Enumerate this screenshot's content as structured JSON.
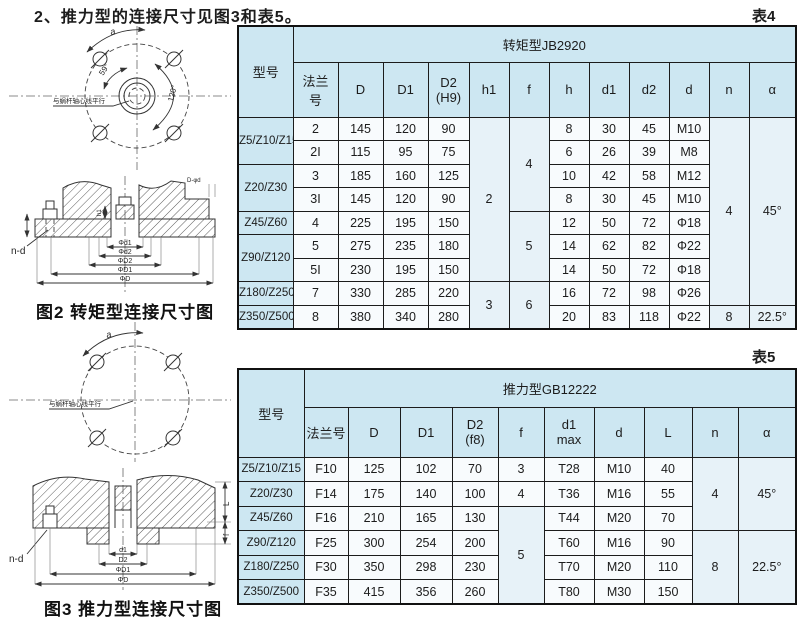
{
  "header": {
    "title": "2、推力型的连接尺寸见图3和表5。",
    "table4_tag": "表4",
    "table5_tag": "表5"
  },
  "figures": {
    "fig2": {
      "caption": "图2 转矩型连接尺寸图",
      "a_label": "a",
      "angle_small": "59°",
      "angle_large": "120°",
      "note": "与蜗杆轴心线平行",
      "bolt_label": "n-d",
      "top_right_label": "D-φd",
      "h1_label": "h1",
      "dims": [
        "Φd1",
        "Φd2",
        "ΦD2",
        "ΦD1",
        "ΦD"
      ]
    },
    "fig3": {
      "caption": "图3 推力型连接尺寸图",
      "a_label": "a",
      "note": "与蜗杆轴心线平行",
      "bolt_label": "n-d",
      "L_label": "L",
      "f_label": "f",
      "dims": [
        "d1",
        "D2",
        "ΦD1",
        "ΦD"
      ]
    }
  },
  "tables": {
    "table4": {
      "group_header": "转矩型JB2920",
      "rows": [
        [
          {
            "t": "型号",
            "th": 1,
            "rs": 2,
            "n": "col-header-model"
          },
          {
            "t": "转矩型JB2920",
            "th": 1,
            "cs": 12,
            "n": "table4-group-header"
          }
        ],
        [
          {
            "t": "法兰\n号",
            "th": 1,
            "n": "col-header"
          },
          {
            "t": "D",
            "th": 1,
            "n": "col-header"
          },
          {
            "t": "D1",
            "th": 1,
            "n": "col-header"
          },
          {
            "t": "D2\n(H9)",
            "th": 1,
            "n": "col-header"
          },
          {
            "t": "h1",
            "th": 1,
            "n": "col-header"
          },
          {
            "t": "f",
            "th": 1,
            "n": "col-header"
          },
          {
            "t": "h",
            "th": 1,
            "n": "col-header"
          },
          {
            "t": "d1",
            "th": 1,
            "n": "col-header"
          },
          {
            "t": "d2",
            "th": 1,
            "n": "col-header"
          },
          {
            "t": "d",
            "th": 1,
            "n": "col-header"
          },
          {
            "t": "n",
            "th": 1,
            "n": "col-header"
          },
          {
            "t": "α",
            "th": 1,
            "n": "col-header"
          }
        ],
        [
          {
            "t": "Z5/Z10/Z15",
            "rs": 2,
            "cls": "model",
            "n": "row-header"
          },
          {
            "t": "2"
          },
          {
            "t": "145"
          },
          {
            "t": "120"
          },
          {
            "t": "90"
          },
          {
            "t": "2",
            "rs": 7,
            "cls": "span"
          },
          {
            "t": "4",
            "rs": 4,
            "cls": "span"
          },
          {
            "t": "8"
          },
          {
            "t": "30"
          },
          {
            "t": "45"
          },
          {
            "t": "M10"
          },
          {
            "t": "4",
            "rs": 8,
            "cls": "span"
          },
          {
            "t": "45°",
            "rs": 8,
            "cls": "span"
          }
        ],
        [
          {
            "t": "2I"
          },
          {
            "t": "115"
          },
          {
            "t": "95"
          },
          {
            "t": "75"
          },
          {
            "t": "6"
          },
          {
            "t": "26"
          },
          {
            "t": "39"
          },
          {
            "t": "M8"
          }
        ],
        [
          {
            "t": "Z20/Z30",
            "rs": 2,
            "cls": "model",
            "n": "row-header"
          },
          {
            "t": "3"
          },
          {
            "t": "185"
          },
          {
            "t": "160"
          },
          {
            "t": "125"
          },
          {
            "t": "10"
          },
          {
            "t": "42"
          },
          {
            "t": "58"
          },
          {
            "t": "M12"
          }
        ],
        [
          {
            "t": "3I"
          },
          {
            "t": "145"
          },
          {
            "t": "120"
          },
          {
            "t": "90"
          },
          {
            "t": "8"
          },
          {
            "t": "30"
          },
          {
            "t": "45"
          },
          {
            "t": "M10"
          }
        ],
        [
          {
            "t": "Z45/Z60",
            "cls": "model",
            "n": "row-header"
          },
          {
            "t": "4"
          },
          {
            "t": "225"
          },
          {
            "t": "195"
          },
          {
            "t": "150"
          },
          {
            "t": "5",
            "rs": 3,
            "cls": "span"
          },
          {
            "t": "12"
          },
          {
            "t": "50"
          },
          {
            "t": "72"
          },
          {
            "t": "Φ18"
          }
        ],
        [
          {
            "t": "Z90/Z120",
            "rs": 2,
            "cls": "model",
            "n": "row-header"
          },
          {
            "t": "5"
          },
          {
            "t": "275"
          },
          {
            "t": "235"
          },
          {
            "t": "180"
          },
          {
            "t": "14"
          },
          {
            "t": "62"
          },
          {
            "t": "82"
          },
          {
            "t": "Φ22"
          }
        ],
        [
          {
            "t": "5I"
          },
          {
            "t": "230"
          },
          {
            "t": "195"
          },
          {
            "t": "150"
          },
          {
            "t": "14"
          },
          {
            "t": "50"
          },
          {
            "t": "72"
          },
          {
            "t": "Φ18"
          }
        ],
        [
          {
            "t": "Z180/Z250",
            "cls": "model",
            "n": "row-header"
          },
          {
            "t": "7"
          },
          {
            "t": "330"
          },
          {
            "t": "285"
          },
          {
            "t": "220"
          },
          {
            "t": "3",
            "rs": 2,
            "cls": "span"
          },
          {
            "t": "6",
            "rs": 2,
            "cls": "span"
          },
          {
            "t": "16"
          },
          {
            "t": "72"
          },
          {
            "t": "98"
          },
          {
            "t": "Φ26"
          }
        ],
        [
          {
            "t": "Z350/Z500",
            "cls": "model",
            "n": "row-header"
          },
          {
            "t": "8"
          },
          {
            "t": "380"
          },
          {
            "t": "340"
          },
          {
            "t": "280"
          },
          {
            "t": "20"
          },
          {
            "t": "83"
          },
          {
            "t": "118"
          },
          {
            "t": "Φ22"
          },
          {
            "t": "8",
            "cls": "span"
          },
          {
            "t": "22.5°",
            "cls": "span"
          }
        ]
      ]
    },
    "table5": {
      "group_header": "推力型GB12222",
      "rows": [
        [
          {
            "t": "型号",
            "th": 1,
            "rs": 2,
            "n": "col-header-model"
          },
          {
            "t": "推力型GB12222",
            "th": 1,
            "cs": 10,
            "n": "table5-group-header"
          }
        ],
        [
          {
            "t": "法兰号",
            "th": 1,
            "n": "col-header"
          },
          {
            "t": "D",
            "th": 1,
            "n": "col-header"
          },
          {
            "t": "D1",
            "th": 1,
            "n": "col-header"
          },
          {
            "t": "D2\n(f8)",
            "th": 1,
            "n": "col-header"
          },
          {
            "t": "f",
            "th": 1,
            "n": "col-header"
          },
          {
            "t": "d1\nmax",
            "th": 1,
            "n": "col-header"
          },
          {
            "t": "d",
            "th": 1,
            "n": "col-header"
          },
          {
            "t": "L",
            "th": 1,
            "n": "col-header"
          },
          {
            "t": "n",
            "th": 1,
            "n": "col-header"
          },
          {
            "t": "α",
            "th": 1,
            "n": "col-header"
          }
        ],
        [
          {
            "t": "Z5/Z10/Z15",
            "cls": "model",
            "n": "row-header"
          },
          {
            "t": "F10"
          },
          {
            "t": "125"
          },
          {
            "t": "102"
          },
          {
            "t": "70"
          },
          {
            "t": "3"
          },
          {
            "t": "T28"
          },
          {
            "t": "M10"
          },
          {
            "t": "40"
          },
          {
            "t": "4",
            "rs": 3,
            "cls": "span"
          },
          {
            "t": "45°",
            "rs": 3,
            "cls": "span"
          }
        ],
        [
          {
            "t": "Z20/Z30",
            "cls": "model",
            "n": "row-header"
          },
          {
            "t": "F14"
          },
          {
            "t": "175"
          },
          {
            "t": "140"
          },
          {
            "t": "100"
          },
          {
            "t": "4"
          },
          {
            "t": "T36"
          },
          {
            "t": "M16"
          },
          {
            "t": "55"
          }
        ],
        [
          {
            "t": "Z45/Z60",
            "cls": "model",
            "n": "row-header"
          },
          {
            "t": "F16"
          },
          {
            "t": "210"
          },
          {
            "t": "165"
          },
          {
            "t": "130"
          },
          {
            "t": "5",
            "rs": 4,
            "cls": "span"
          },
          {
            "t": "T44"
          },
          {
            "t": "M20"
          },
          {
            "t": "70"
          }
        ],
        [
          {
            "t": "Z90/Z120",
            "cls": "model",
            "n": "row-header"
          },
          {
            "t": "F25"
          },
          {
            "t": "300"
          },
          {
            "t": "254"
          },
          {
            "t": "200"
          },
          {
            "t": "T60"
          },
          {
            "t": "M16"
          },
          {
            "t": "90"
          },
          {
            "t": "8",
            "rs": 3,
            "cls": "span"
          },
          {
            "t": "22.5°",
            "rs": 3,
            "cls": "span"
          }
        ],
        [
          {
            "t": "Z180/Z250",
            "cls": "model",
            "n": "row-header"
          },
          {
            "t": "F30"
          },
          {
            "t": "350"
          },
          {
            "t": "298"
          },
          {
            "t": "230"
          },
          {
            "t": "T70"
          },
          {
            "t": "M20"
          },
          {
            "t": "110"
          }
        ],
        [
          {
            "t": "Z350/Z500",
            "cls": "model",
            "n": "row-header"
          },
          {
            "t": "F35"
          },
          {
            "t": "415"
          },
          {
            "t": "356"
          },
          {
            "t": "260"
          },
          {
            "t": "T80"
          },
          {
            "t": "M30"
          },
          {
            "t": "150"
          }
        ]
      ]
    }
  }
}
